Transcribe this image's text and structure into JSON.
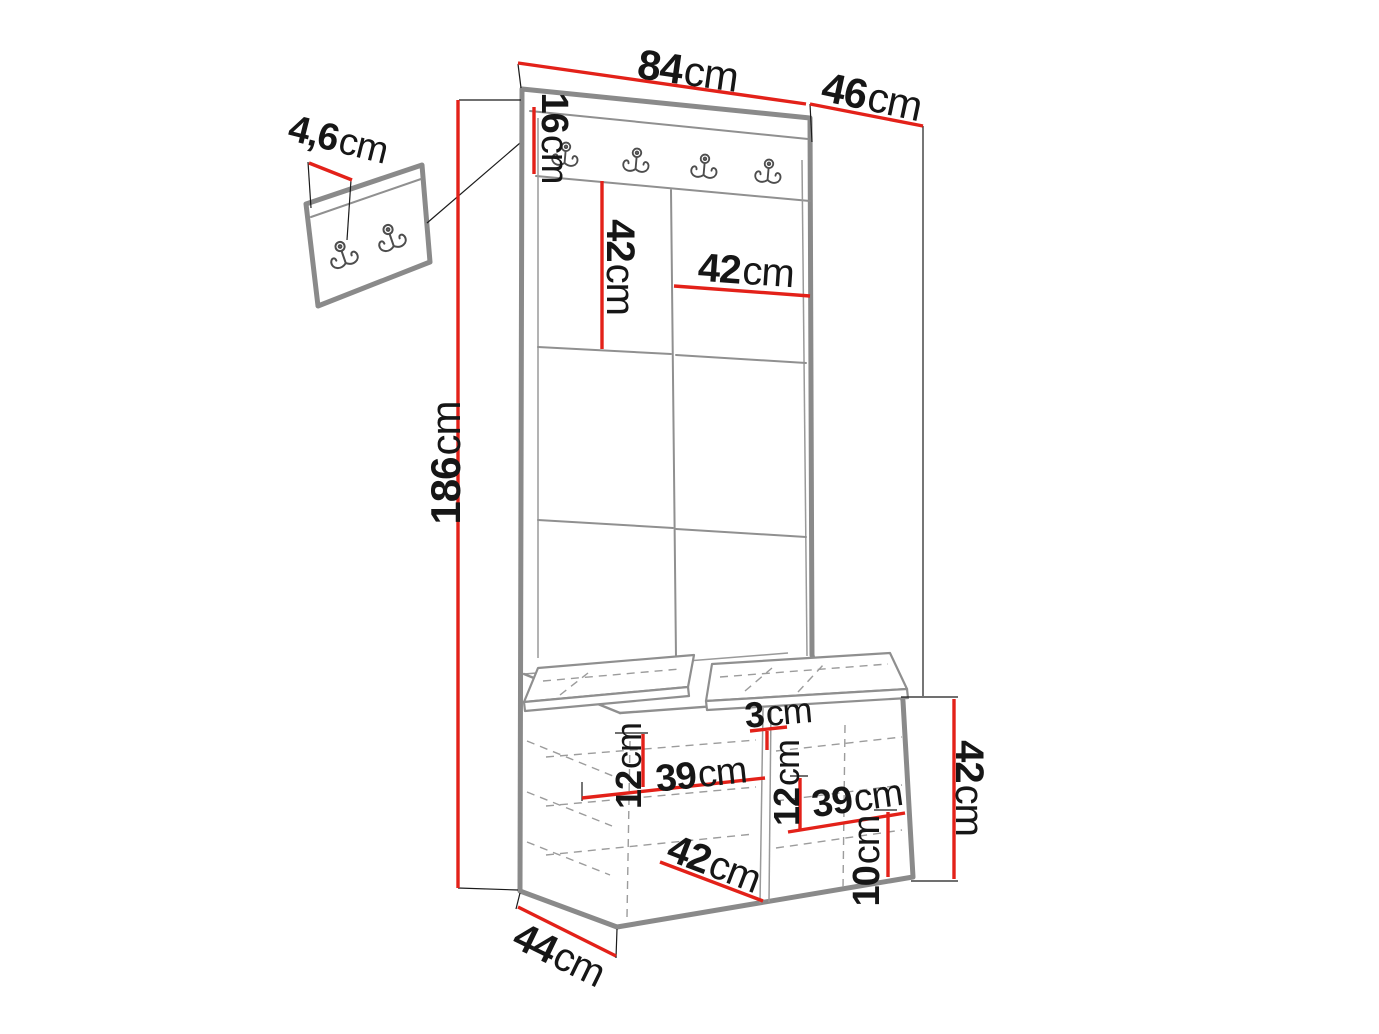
{
  "title": "Hallway furniture set dimension diagram",
  "unit_symbol": "cm",
  "colors": {
    "dimension_line": "#e32119",
    "furniture_outline": "#8a8a8a",
    "hidden_edge": "#9c9c9c",
    "label_text": "#161616"
  },
  "icons": {
    "coat_hook": "double-prong coat hook",
    "main_rail_hook_count": 4,
    "wall_panel_hook_count": 2
  },
  "dimensions": {
    "width_top": {
      "value": "84",
      "unit": "cm"
    },
    "depth_top": {
      "value": "46",
      "unit": "cm"
    },
    "hook_rail_height": {
      "value": "16",
      "unit": "cm"
    },
    "panel_tile_height": {
      "value": "42",
      "unit": "cm"
    },
    "panel_tile_width": {
      "value": "42",
      "unit": "cm"
    },
    "total_height": {
      "value": "186",
      "unit": "cm"
    },
    "wall_panel_size": {
      "value": "4,6",
      "unit": "cm"
    },
    "divider_thickness": {
      "value": "3",
      "unit": "cm"
    },
    "shelf_offset_left": {
      "value": "12",
      "unit": "cm"
    },
    "shelf_width_left": {
      "value": "39",
      "unit": "cm"
    },
    "shelf_offset_right": {
      "value": "12",
      "unit": "cm"
    },
    "shelf_width_right": {
      "value": "39",
      "unit": "cm"
    },
    "bench_height": {
      "value": "42",
      "unit": "cm"
    },
    "bench_inner_width": {
      "value": "42",
      "unit": "cm"
    },
    "bottom_gap_height": {
      "value": "10",
      "unit": "cm"
    },
    "bench_depth": {
      "value": "44",
      "unit": "cm"
    }
  }
}
